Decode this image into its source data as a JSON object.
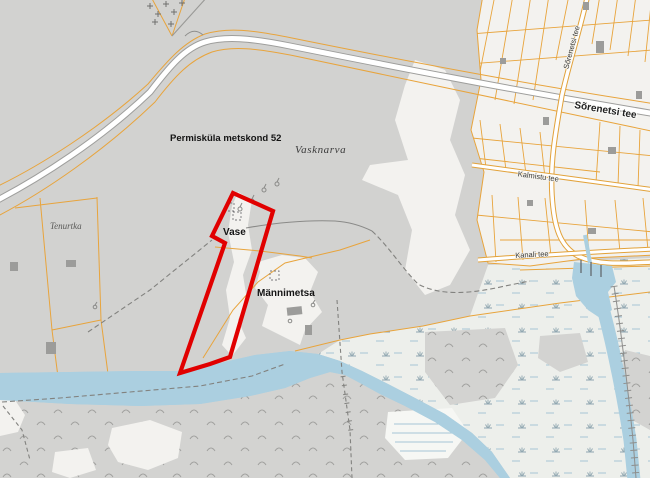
{
  "labels": {
    "forest_compartment": "Permisküla metskond 52",
    "village_name": "Vasknarva",
    "parcel_vase": "Vase",
    "parcel_mannimetsa": "Männimetsa",
    "farmstead": "Tenurtka",
    "road_sorenetsi": "Sõrenetsi tee",
    "road_sorenetsi_north": "Sõrenetsi tee",
    "road_kalmistu": "Kalmistu tee",
    "road_kanali": "Kanali tee"
  },
  "highlight": {
    "points": "233,193 273,211 230,357 210,364 180,373 225,243 212,236",
    "stroke": "#e10000",
    "stroke_width": "4.2"
  },
  "colors": {
    "land": "#d2d2d0",
    "clearing": "#f3f2ef",
    "village_parcels": "#f3f2ef",
    "cadastral_line": "#e8a43c",
    "road_fill": "#ffffff",
    "road_casing_major": "#9e9e9c",
    "road_casing_local": "#e2a23a",
    "water": "#abcfe0",
    "marsh_light": "#edefeb",
    "building": "#9c9c9a",
    "trail": "#82827f",
    "highlight_red": "#e10000"
  },
  "symbols": {
    "cemetery": "cross-markers",
    "marsh": "marsh-tuft-markers",
    "wet_marsh": "blue-dash-markers",
    "springs": "spring-markers",
    "piers": "pier-markers",
    "footbridge": "tick-crossing-marker"
  }
}
